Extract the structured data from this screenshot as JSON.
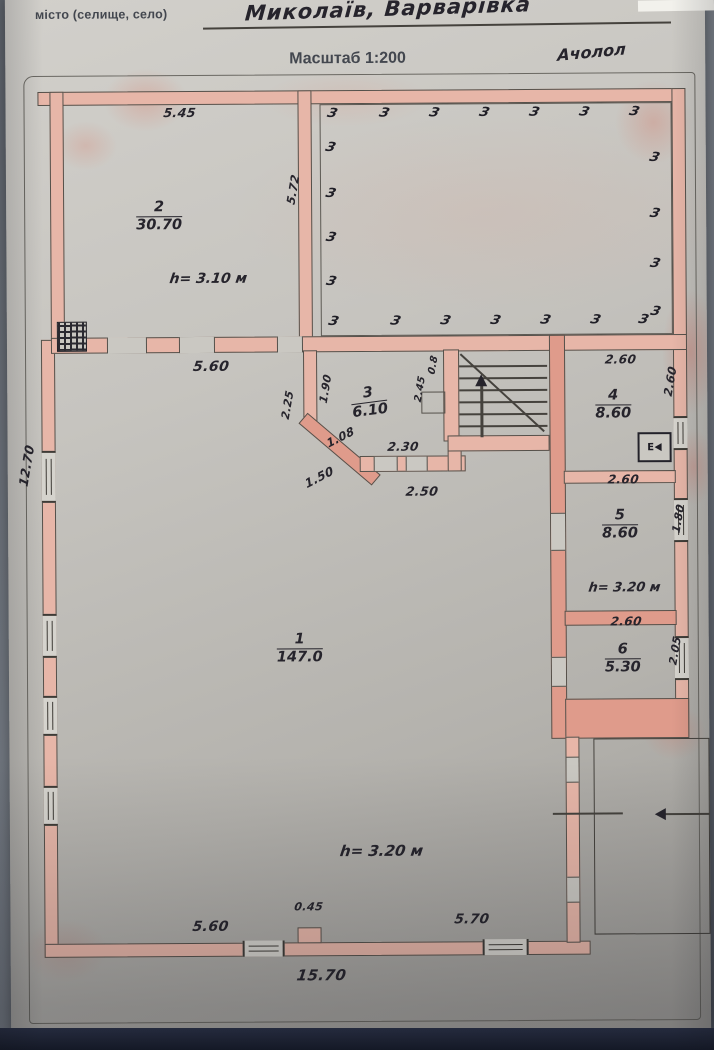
{
  "header": {
    "field_label": "місто (селище, село)",
    "field_value": "Миколаїв, Варварівка",
    "scale_label": "Масштаб 1:200",
    "note": "Ачолол"
  },
  "plan": {
    "hatch_glyph": "З",
    "appliance_label": "Е",
    "rooms": {
      "r1": {
        "num": "1",
        "area": "147.0",
        "height_note": "h= 3.20 м"
      },
      "r2": {
        "num": "2",
        "area": "30.70",
        "height_note": "h= 3.10 м"
      },
      "r3": {
        "num": "3",
        "area": "6.10"
      },
      "r4": {
        "num": "4",
        "area": "8.60"
      },
      "r5": {
        "num": "5",
        "area": "8.60",
        "height_note": "h= 3.20 м"
      },
      "r6": {
        "num": "6",
        "area": "5.30"
      }
    },
    "dims": {
      "room2_top": "5.45",
      "room2_right": "5.72",
      "hall_width": "5.60",
      "left_side": "12.70",
      "room3_left": "1.90",
      "room3_outside_left": "2.25",
      "room3_niche_width": "0.8",
      "room3_niche_height": "2.45",
      "room3_chamfer_inner": "1.08",
      "room3_door_span": "2.30",
      "room3_chamfer_outer": "1.50",
      "room3_bottom": "2.50",
      "room4_top": "2.60",
      "room4_right": "2.60",
      "room5_top": "2.60",
      "room5_right": "1.80",
      "room6_top": "2.60",
      "room6_right": "2.05",
      "bottom_left": "5.60",
      "bottom_ledge": "0.45",
      "bottom_right": "5.70",
      "bottom_total": "15.70"
    }
  }
}
